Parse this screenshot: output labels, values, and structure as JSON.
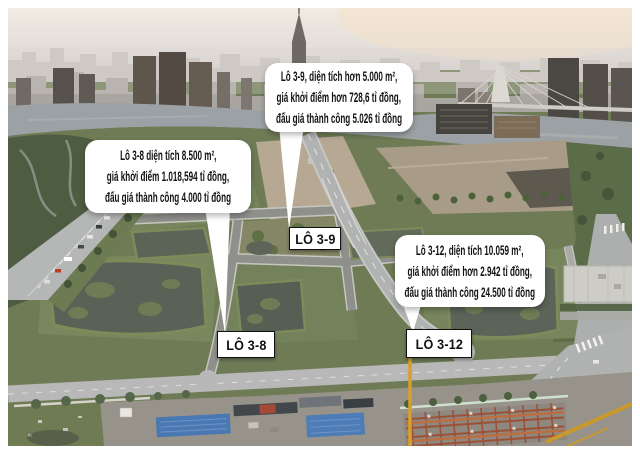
{
  "callouts": [
    {
      "id": "lo-3-9",
      "lines": [
        "Lô 3-9, diện tích hơn 5.000 m²,",
        "giá khởi điểm hơn 728,6 tỉ đồng,",
        "đấu giá thành công 5.026 tỉ đồng"
      ]
    },
    {
      "id": "lo-3-8",
      "lines": [
        "Lô 3-8 diện tích 8.500 m²,",
        "giá khởi điểm 1.018,594 tỉ đồng,",
        "đấu giá thành công 4.000 tỉ đồng"
      ]
    },
    {
      "id": "lo-3-12",
      "lines": [
        "Lô 3-12, diện tích 10.059 m²,",
        "giá khởi điểm hơn 2.942 tỉ đồng,",
        "đấu giá thành công 24.500 tỉ đồng"
      ]
    }
  ],
  "plot_labels": [
    {
      "id": "lo-3-9",
      "text": "LÔ 3-9"
    },
    {
      "id": "lo-3-8",
      "text": "LÔ 3-8"
    },
    {
      "id": "lo-3-12",
      "text": "LÔ 3-12"
    }
  ],
  "colors": {
    "frame_bg": "#ffffff",
    "callout_bg": "#ffffff",
    "callout_text": "#111111",
    "label_border": "#111111",
    "sky_haze": "#ece6df",
    "river": "#9ba1a4",
    "vegetation": "#6e7b55",
    "pond_water": "#5a6156",
    "road_concrete": "#b4b6b6",
    "asphalt": "#8f908b",
    "blue_roof": "#4a78b2",
    "steel_rust": "#9c5136",
    "crane_yellow": "#d5a02c"
  }
}
